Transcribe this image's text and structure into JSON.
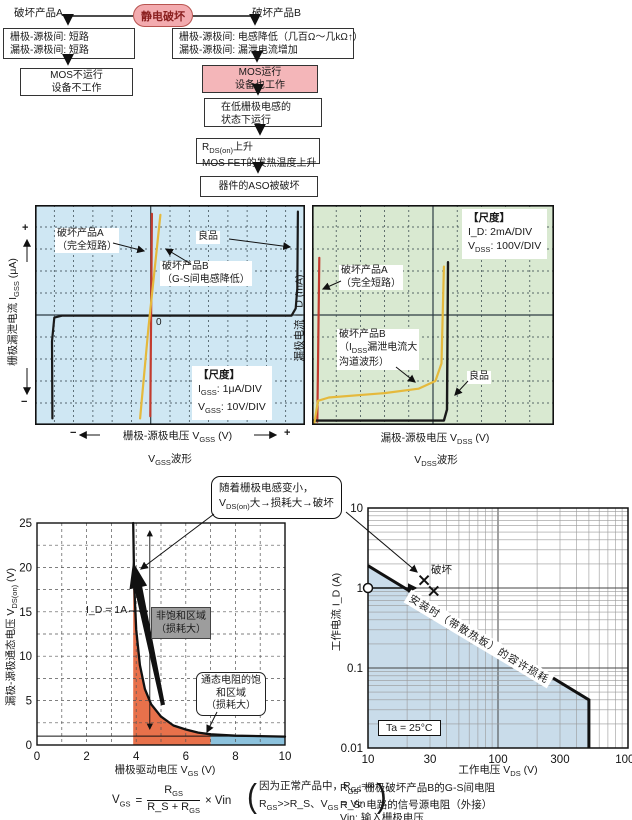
{
  "colors": {
    "pink_fill": "#f4b6b9",
    "pink_border": "#b85450",
    "trigger_text": "#8b2020",
    "blue_bg": "#cfe7f3",
    "green_bg": "#d9e9d1",
    "red_line": "#c23b2e",
    "yellow_line": "#e5b93c",
    "black_line": "#1a1a1a",
    "orange_region": "#e8714b",
    "lightblue_region": "#8cc2dd",
    "aso_blue_region": "#c9dcea"
  },
  "flowchart": {
    "label_a": "破坏产品A",
    "trigger": "静电破坏",
    "label_b": "破坏产品B",
    "box_a_line1": "栅极-源极间: 短路",
    "box_a_line2": "漏极-源极间: 短路",
    "box_b_line1": "栅极-源极间: 电感降低（几百Ω～几kΩ↑）",
    "box_b_line2": "漏极-源极间: 漏泄电流增加",
    "mos_a_line1": "MOS不运行",
    "mos_a_line2": "设备不工作",
    "mos_b_line1": "MOS运行",
    "mos_b_line2": "设备也工作",
    "lowl_line1": "在低栅极电感的",
    "lowl_line2": "状态下运行",
    "rds_line1": "R_{DS(on)}上升",
    "rds_line2": "MOS FET的发热温度上升",
    "aso": "器件的ASO被破坏"
  },
  "callout": {
    "line1": "随着栅极电感变小，",
    "line2": "V_{DS(on)}大→损耗大→破坏"
  },
  "chart_data": [
    {
      "id": "vgss_waveform",
      "type": "line",
      "title": "V_{GSS}波形",
      "xlabel": "栅极-源极电压  V_{GSS}  (V)",
      "xlabel_neg": "−",
      "xlabel_pos": "+",
      "ylabel": "栅极漏泄电流  I_{GSS}  (μA)",
      "ylabel_pos": "+",
      "ylabel_neg": "−",
      "zero_label": "0",
      "scale_title": "【尺度】",
      "scale_lines": [
        "I_{GSS}:  1μA/DIV",
        "V_{GSS}:  10V/DIV"
      ],
      "divisions": {
        "cols": 14,
        "rows": 10,
        "axis_col": 6,
        "axis_row": 5
      },
      "series": [
        {
          "name": "良品",
          "color_key": "black_line",
          "width": 2.2,
          "points_div": [
            [
              -5.1,
              -4.7
            ],
            [
              -5.12,
              -1.2
            ],
            [
              -5.0,
              -0.12
            ],
            [
              -4.6,
              -0.03
            ],
            [
              7.3,
              -0.03
            ],
            [
              7.52,
              0.3
            ],
            [
              7.6,
              1.2
            ],
            [
              7.63,
              4.7
            ]
          ]
        },
        {
          "name": "破坏产品A（完全短路）",
          "color_key": "red_line",
          "width": 2.2,
          "points_div": [
            [
              -0.02,
              -4.6
            ],
            [
              0.06,
              4.6
            ]
          ]
        },
        {
          "name": "破坏产品B（G-S间电感降低）",
          "color_key": "yellow_line",
          "width": 2.2,
          "points_div": [
            [
              -0.55,
              -4.7
            ],
            [
              -0.12,
              -0.6
            ],
            [
              0.5,
              4.55
            ]
          ]
        }
      ],
      "labels": {
        "prod_a": [
          "破坏产品A",
          "（完全短路）"
        ],
        "prod_b": [
          "破坏产品B",
          "（G-S间电感降低）"
        ],
        "good": "良品"
      }
    },
    {
      "id": "vdss_waveform",
      "type": "line",
      "title": "V_{DSS}波形",
      "xlabel": "漏极-源极电压  V_{DSS}  (V)",
      "ylabel": "漏极电流  I_D  (mA)",
      "scale_title": "【尺度】",
      "scale_lines": [
        "I_D:  2mA/DIV",
        "V_{DSS}:  100V/DIV"
      ],
      "divisions": {
        "cols": 10,
        "rows": 10,
        "axis_col": 5,
        "axis_row": 5
      },
      "series": [
        {
          "name": "破坏产品A（完全短路）",
          "color_key": "red_line",
          "width": 2.2,
          "points_div": [
            [
              -4.78,
              -4.85
            ],
            [
              -4.7,
              2.6
            ]
          ]
        },
        {
          "name": "良品",
          "color_key": "black_line",
          "width": 2.4,
          "points_div": [
            [
              -4.95,
              -4.8
            ],
            [
              0.45,
              -4.8
            ],
            [
              0.58,
              -4.3
            ],
            [
              0.62,
              2.4
            ]
          ]
        },
        {
          "name": "破坏产品B（漏泄电流大，沟道波形）",
          "color_key": "yellow_line",
          "width": 2.2,
          "points_div": [
            [
              -4.9,
              -4.9
            ],
            [
              -4.75,
              -3.9
            ],
            [
              -4.3,
              -3.75
            ],
            [
              -2.0,
              -3.55
            ],
            [
              -0.6,
              -3.35
            ],
            [
              0.1,
              -3.0
            ],
            [
              0.35,
              -2.2
            ],
            [
              0.45,
              2.2
            ]
          ]
        }
      ],
      "labels": {
        "prod_a": [
          "破坏产品A",
          "（完全短路）"
        ],
        "prod_b": [
          "破坏产品B",
          "（I_{DSS}漏泄电流大",
          "沟道波形）"
        ],
        "good": "良品"
      }
    },
    {
      "id": "vdson_vs_vgs",
      "type": "line",
      "xlabel": "栅极驱动电压  V_{GS}  (V)",
      "ylabel": "漏极-源极通态电压  V_{DS(on)}  (V)",
      "x_ticks": [
        0,
        2,
        4,
        6,
        8,
        10
      ],
      "y_ticks": [
        0,
        5,
        10,
        15,
        20,
        25
      ],
      "xlim": [
        0,
        10
      ],
      "ylim": [
        0,
        25
      ],
      "curve_label": "I_D = 1A",
      "curve": [
        [
          3.88,
          25
        ],
        [
          3.92,
          18
        ],
        [
          4.0,
          13
        ],
        [
          4.15,
          9
        ],
        [
          4.35,
          6.3
        ],
        [
          4.6,
          4.6
        ],
        [
          5.0,
          3.2
        ],
        [
          5.5,
          2.2
        ],
        [
          6.0,
          1.75
        ],
        [
          6.5,
          1.4
        ],
        [
          7.0,
          1.2
        ],
        [
          8.0,
          1.05
        ],
        [
          9.0,
          1.0
        ],
        [
          10,
          0.95
        ]
      ],
      "ref_line_y": 1,
      "regions": [
        {
          "name": "非饱和区域（损耗大）",
          "x_range": [
            3.88,
            7
          ],
          "color_key": "orange_region"
        },
        {
          "name": "通态电阻的饱和区域（损耗大）",
          "x_range": [
            7,
            10
          ],
          "color_key": "lightblue_region"
        }
      ],
      "labels": {
        "unsat": [
          "非饱和区域",
          "（损耗大）"
        ],
        "sat": [
          "通态电阻的饱",
          "和区域",
          "（损耗大）"
        ]
      }
    },
    {
      "id": "aso",
      "type": "line",
      "xscale": "log",
      "yscale": "log",
      "xlabel": "工作电压  V_{DS}  (V)",
      "ylabel": "工作电流  I_D  (A)",
      "x_ticks": [
        10,
        30,
        100,
        300,
        1000
      ],
      "y_ticks": [
        0.01,
        0.1,
        1,
        10
      ],
      "xlim": [
        10,
        1000
      ],
      "ylim": [
        0.01,
        10
      ],
      "boundary": [
        [
          10,
          1.9
        ],
        [
          500,
          0.04
        ],
        [
          500,
          0.01
        ]
      ],
      "boundary_label": "安装时（带散热板）的容许损耗",
      "markers": {
        "circle": [
          10,
          1
        ],
        "crosses": [
          [
            27,
            1.25
          ],
          [
            32,
            0.92
          ]
        ],
        "label": "破坏"
      },
      "ta_label": "Ta = 25°C"
    }
  ],
  "formula": {
    "lhs": "V_{GS}",
    "eq": "=",
    "num": "R_{GS}",
    "den": "R_S + R_{GS}",
    "rhs": "× Vin",
    "note_open": "(",
    "note_close": ")",
    "note_line1": "因为正常产品中，R_{GS}≈∞",
    "note_line2": "R_{GS}>>R_S、V_{GS} = Vin",
    "defs": [
      "R_{GS}:  栅极破坏产品B的G-S间电阻",
      "R_S:  电路的信号源电阻（外接）",
      "Vin:  输入栅极电压"
    ]
  }
}
